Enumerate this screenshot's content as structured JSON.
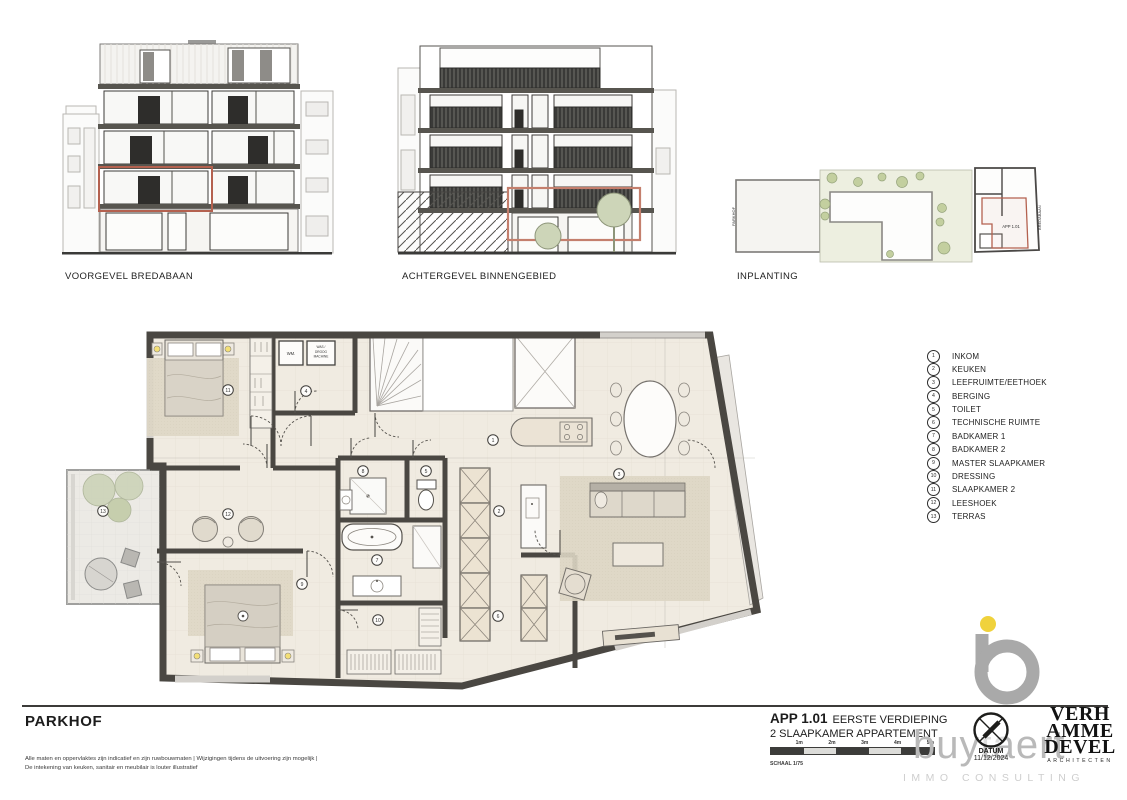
{
  "drawings": {
    "front": {
      "label": "VOORGEVEL BREDABAAN"
    },
    "rear": {
      "label": "ACHTERGEVEL BINNENGEBIED"
    },
    "site": {
      "label": "INPLANTING",
      "apartment_tag": "APP 1.01",
      "street_left": "PARKHOF",
      "street_right": "BREDABAAN"
    }
  },
  "legend": {
    "items": [
      {
        "num": "1",
        "label": "INKOM"
      },
      {
        "num": "2",
        "label": "KEUKEN"
      },
      {
        "num": "3",
        "label": "LEEFRUIMTE/EETHOEK"
      },
      {
        "num": "4",
        "label": "BERGING"
      },
      {
        "num": "5",
        "label": "TOILET"
      },
      {
        "num": "6",
        "label": "TECHNISCHE RUIMTE"
      },
      {
        "num": "7",
        "label": "BADKAMER 1"
      },
      {
        "num": "8",
        "label": "BADKAMER 2"
      },
      {
        "num": "9",
        "label": "MASTER SLAAPKAMER"
      },
      {
        "num": "10",
        "label": "DRESSING"
      },
      {
        "num": "11",
        "label": "SLAAPKAMER 2"
      },
      {
        "num": "12",
        "label": "LEESHOEK"
      },
      {
        "num": "13",
        "label": "TERRAS"
      }
    ]
  },
  "plan": {
    "labels": {
      "wm": "WM.",
      "wash1": "WAS /",
      "wash2": "DROOG",
      "wash3": "MACHINE"
    },
    "markers": [
      {
        "num": "1",
        "x": 438,
        "y": 122
      },
      {
        "num": "2",
        "x": 444,
        "y": 193
      },
      {
        "num": "3",
        "x": 564,
        "y": 156
      },
      {
        "num": "4",
        "x": 251,
        "y": 73
      },
      {
        "num": "5",
        "x": 371,
        "y": 153
      },
      {
        "num": "6",
        "x": 443,
        "y": 298
      },
      {
        "num": "7",
        "x": 322,
        "y": 242
      },
      {
        "num": "8",
        "x": 308,
        "y": 153
      },
      {
        "num": "9",
        "x": 247,
        "y": 266
      },
      {
        "num": "10",
        "x": 323,
        "y": 302
      },
      {
        "num": "11",
        "x": 173,
        "y": 72
      },
      {
        "num": "12",
        "x": 173,
        "y": 196
      },
      {
        "num": "13",
        "x": 48,
        "y": 193
      }
    ]
  },
  "footer": {
    "project_title": "PARKHOF",
    "disclaimer1": "Alle maten en oppervlaktes zijn indicatief en zijn ruwbouwmaten | Wijzigingen tijdens de uitvoering zijn mogelijk |",
    "disclaimer2": "De intekening van keuken, sanitair en meubilair is louter illustratief",
    "app_code": "APP 1.01",
    "app_floor": "EERSTE VERDIEPING",
    "app_type": "2 SLAAPKAMER APPARTEMENT",
    "scale_label": "SCHAAL 1/75",
    "scale_ticks": [
      {
        "label": "1m"
      },
      {
        "label": "2m"
      },
      {
        "label": "3m"
      },
      {
        "label": "4m"
      },
      {
        "label": "5m"
      }
    ],
    "datum_label": "DATUM",
    "datum_value": "11/12/2024",
    "broker_name": "buytaert",
    "broker_tagline": "IMMO CONSULTING",
    "architect_line1": "VERH",
    "architect_line2": "AMME",
    "architect_line3": "DEVEL",
    "architect_subtitle": "ARCHITECTEN"
  },
  "colors": {
    "wall": "#4a4742",
    "floor": "#f0ebe1",
    "rug": "#ddd6c4",
    "accent_red": "#b4614f",
    "brand_yellow": "#f0d23c",
    "tree_green": "#ccd3b8"
  }
}
